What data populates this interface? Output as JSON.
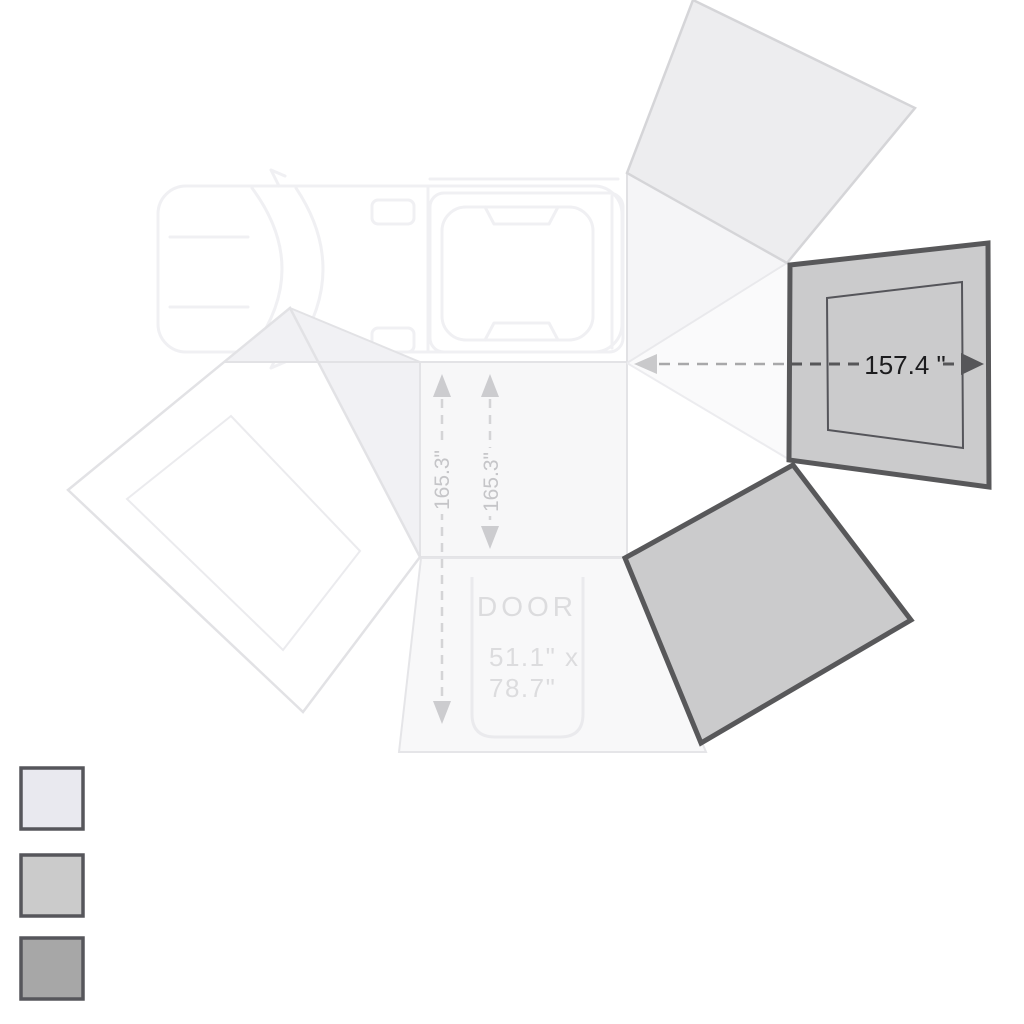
{
  "diagram": {
    "name": "270-degree vehicle awning top view with wall panels",
    "dimensions": {
      "panel_width": "157.4 \"",
      "depth_left": "165.3\"",
      "depth_right": "165.3\""
    },
    "door": {
      "label": "DOOR",
      "size_line1": "51.1\" x",
      "size_line2": "78.7\""
    },
    "colors": {
      "background": "#ffffff",
      "wall_panel_fill": "#cbcbcc",
      "wall_panel_border": "#58585a",
      "top_panel_fill": "#ededef",
      "dim_text_dark": "#1c1c1e",
      "dim_text_light": "#c5c5c8",
      "door_text": "#dcdcde"
    },
    "legend": {
      "swatches": [
        {
          "name": "shade-light",
          "fill": "#e9e9ef"
        },
        {
          "name": "shade-medium",
          "fill": "#cbcbcb"
        },
        {
          "name": "shade-dark",
          "fill": "#a7a7a7"
        }
      ]
    }
  }
}
